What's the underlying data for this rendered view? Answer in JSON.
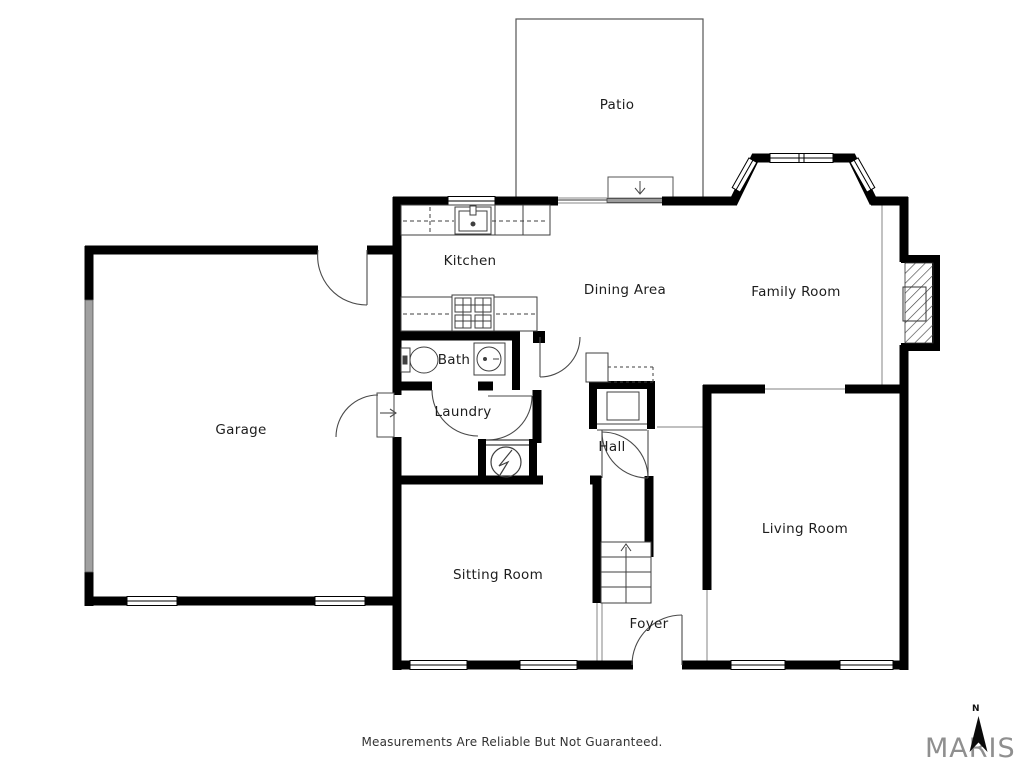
{
  "floorplan": {
    "rooms": [
      {
        "id": "patio",
        "label": "Patio"
      },
      {
        "id": "kitchen",
        "label": "Kitchen"
      },
      {
        "id": "dining-area",
        "label": "Dining Area"
      },
      {
        "id": "family-room",
        "label": "Family Room"
      },
      {
        "id": "garage",
        "label": "Garage"
      },
      {
        "id": "bath",
        "label": "Bath"
      },
      {
        "id": "laundry",
        "label": "Laundry"
      },
      {
        "id": "hall",
        "label": "Hall"
      },
      {
        "id": "sitting-room",
        "label": "Sitting Room"
      },
      {
        "id": "living-room",
        "label": "Living Room"
      },
      {
        "id": "foyer",
        "label": "Foyer"
      }
    ],
    "fixtures": [
      "kitchen-sink",
      "range-cooktop",
      "refrigerator",
      "toilet",
      "bath-sink",
      "water-heater",
      "fireplace",
      "stairs-up",
      "bay-window",
      "garage-door",
      "sliding-patio-door",
      "hall-closet"
    ],
    "colors": {
      "wall": "#000000",
      "thin_line": "#3f3f3f",
      "opening_line": "#9a9a9a",
      "garage_door_fill": "#a0a0a0",
      "brand_gray": "#8f8f8f",
      "background": "#ffffff"
    }
  },
  "footer": {
    "disclaimer": "Measurements Are Reliable But Not Guaranteed."
  },
  "branding": {
    "logo_text": "MARIS",
    "compass_label": "N"
  }
}
